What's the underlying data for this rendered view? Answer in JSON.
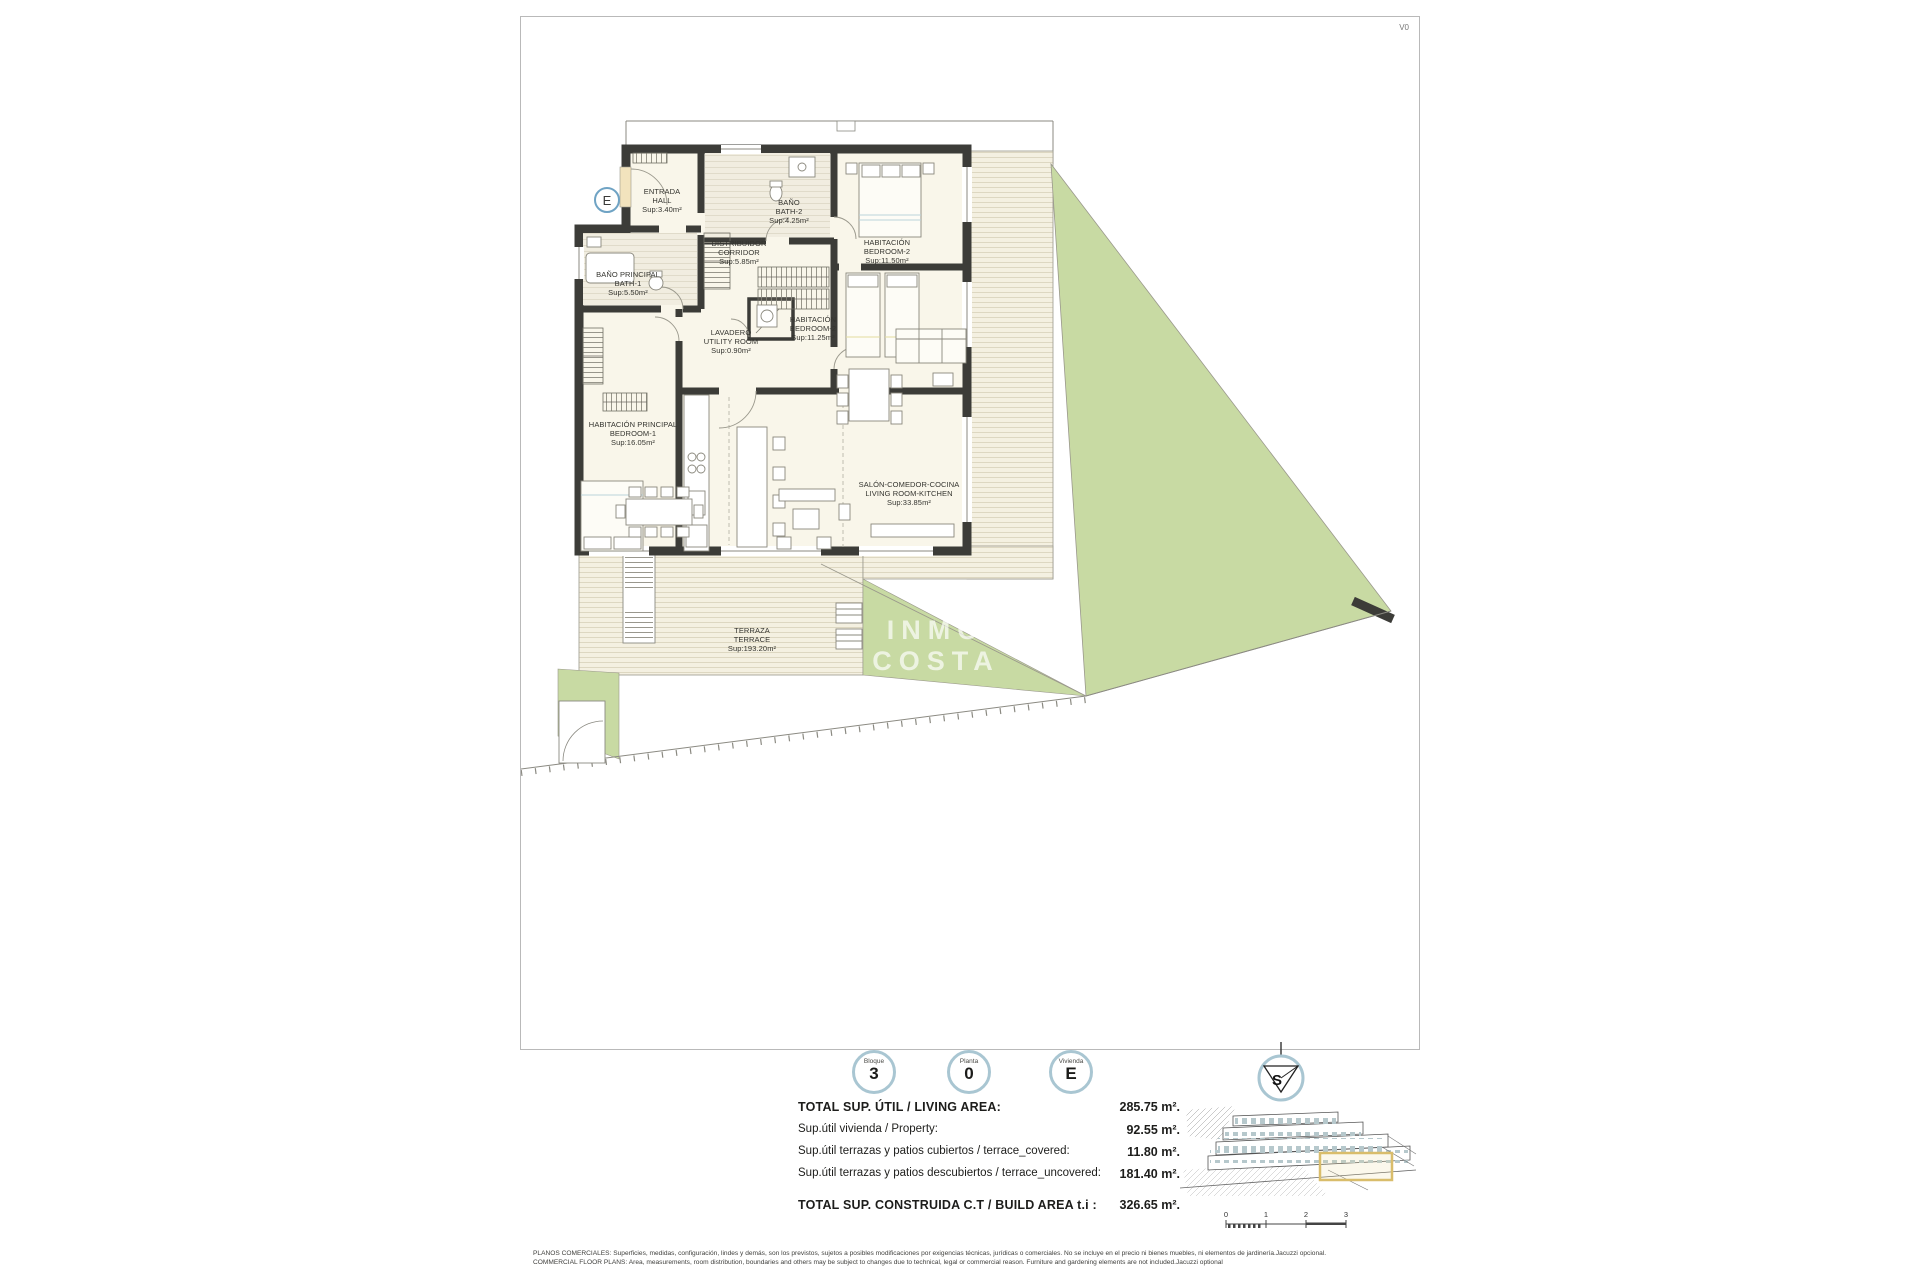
{
  "meta": {
    "version_label": "V0"
  },
  "plan": {
    "unit_marker": "E",
    "watermark_lines": [
      "INMO",
      "COSTA"
    ],
    "rooms": [
      {
        "name_es": "ENTRADA",
        "name_en": "HALL",
        "area": "Sup:3.40m²"
      },
      {
        "name_es": "BAÑO",
        "name_en": "BATH-2",
        "area": "Sup:4.25m²"
      },
      {
        "name_es": "DISTRIBUIDOR",
        "name_en": "CORRIDOR",
        "area": "Sup:5.85m²"
      },
      {
        "name_es": "HABITACIÓN",
        "name_en": "BEDROOM-2",
        "area": "Sup:11.50m²"
      },
      {
        "name_es": "BAÑO PRINCIPAL",
        "name_en": "BATH-1",
        "area": "Sup:5.50m²"
      },
      {
        "name_es": "LAVADERO",
        "name_en": "UTILITY ROOM",
        "area": "Sup:0.90m²"
      },
      {
        "name_es": "HABITACIÓN",
        "name_en": "BEDROOM-2",
        "area": "Sup:11.25m²"
      },
      {
        "name_es": "HABITACIÓN PRINCIPAL",
        "name_en": "BEDROOM-1",
        "area": "Sup:16.05m²"
      },
      {
        "name_es": "SALÓN-COMEDOR-COCINA",
        "name_en": "LIVING ROOM-KITCHEN",
        "area": "Sup:33.85m²"
      },
      {
        "name_es": "TERRAZA",
        "name_en": "TERRACE",
        "area": "Sup:193.20m²"
      }
    ]
  },
  "legend": {
    "badges": [
      {
        "label": "Bloque",
        "value": "3"
      },
      {
        "label": "Planta",
        "value": "0"
      },
      {
        "label": "Vivienda",
        "value": "E"
      }
    ],
    "compass_letter": "S",
    "areas": [
      {
        "label": "TOTAL SUP. ÚTIL / LIVING AREA:",
        "value": "285.75 m²."
      },
      {
        "label": "Sup.útil vivienda / Property:",
        "value": "92.55 m²."
      },
      {
        "label": "Sup.útil terrazas y patios cubiertos / terrace_covered:",
        "value": "11.80 m²."
      },
      {
        "label": "Sup.útil terrazas y patios descubiertos / terrace_uncovered:",
        "value": "181.40 m²."
      },
      {
        "label": "TOTAL SUP. CONSTRUIDA C.T / BUILD AREA t.i :",
        "value": "326.65 m²."
      }
    ],
    "scale_ticks": [
      "0",
      "1",
      "2",
      "3"
    ]
  },
  "footer": {
    "line1": "PLANOS COMERCIALES: Superficies, medidas, configuración, lindes y demás, son los previstos, sujetos a posibles modificaciones por exigencias técnicas, jurídicas o comerciales. No se incluye en el precio ni bienes muebles, ni elementos de jardinería.Jacuzzi opcional.",
    "line2": "COMMERCIAL FLOOR PLANS: Area, measurements, room distribution, boundaries and others may be subject to changes due to technical, legal or commercial reason. Furniture and gardening elements are not included.Jacuzzi optional"
  },
  "colors": {
    "accent_circle": "#a9c6d2",
    "garden_green": "#c8daa3",
    "wall": "#3c3c38",
    "room_fill": "#f9f6ea",
    "deck_base": "#f4f0e1",
    "deck_line": "#ddd7c1",
    "highlight_yellow": "#d9bd6b"
  }
}
